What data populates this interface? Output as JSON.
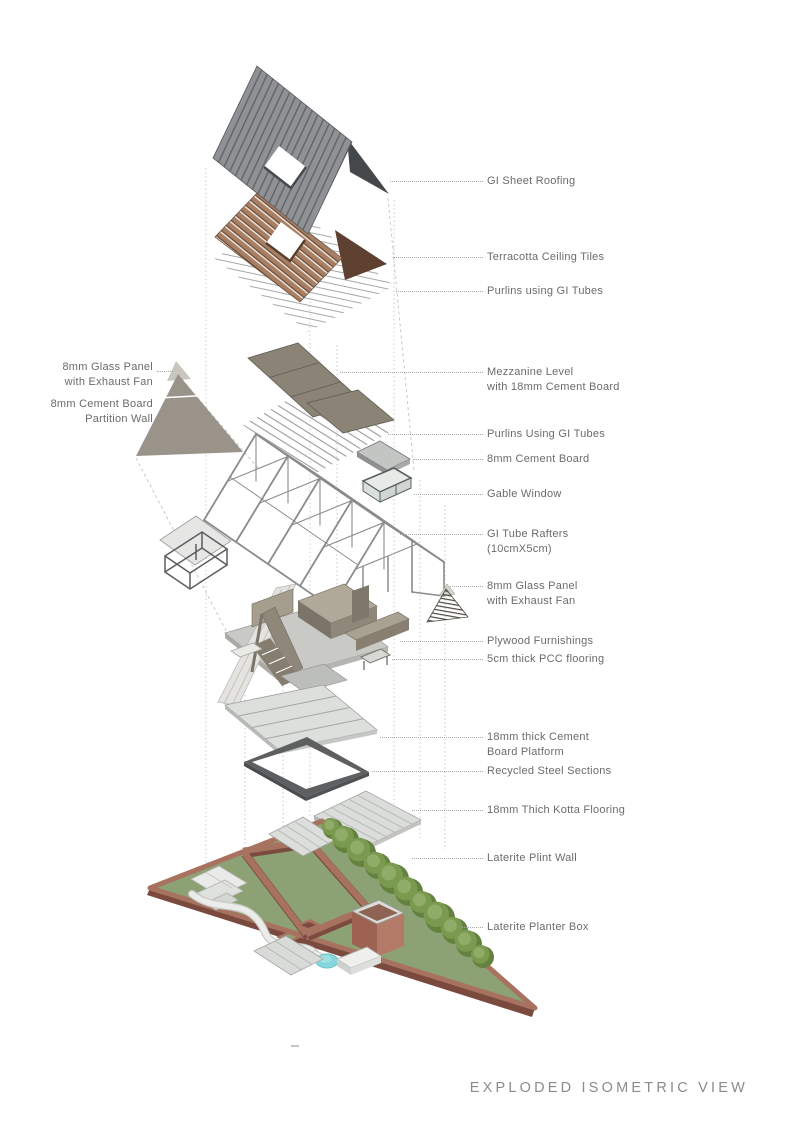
{
  "title": "EXPLODED ISOMETRIC VIEW",
  "callouts_right": [
    {
      "id": "gi-sheet-roofing",
      "lines": [
        "GI Sheet Roofing"
      ],
      "y": 181,
      "from_x": 390
    },
    {
      "id": "terracotta-ceiling-tiles",
      "lines": [
        "Terracotta Ceiling Tiles"
      ],
      "y": 257,
      "from_x": 393
    },
    {
      "id": "purlins-using-gi-tubes-upper",
      "lines": [
        "Purlins using GI Tubes"
      ],
      "y": 291,
      "from_x": 396
    },
    {
      "id": "mezzanine-level",
      "lines": [
        "Mezzanine Level",
        "with 18mm Cement Board"
      ],
      "y": 372,
      "from_x": 340
    },
    {
      "id": "purlins-using-gi-tubes-lower",
      "lines": [
        "Purlins Using GI Tubes"
      ],
      "y": 434,
      "from_x": 388
    },
    {
      "id": "cement-board-8mm",
      "lines": [
        "8mm Cement Board"
      ],
      "y": 459,
      "from_x": 413
    },
    {
      "id": "gable-window",
      "lines": [
        "Gable Window"
      ],
      "y": 494,
      "from_x": 414
    },
    {
      "id": "gi-tube-rafters",
      "lines": [
        "GI Tube Rafters",
        "(10cmX5cm)"
      ],
      "y": 534,
      "from_x": 400
    },
    {
      "id": "glass-panel-exhaust-fan-right",
      "lines": [
        "8mm Glass Panel",
        "with Exhaust Fan"
      ],
      "y": 586,
      "from_x": 450
    },
    {
      "id": "plywood-furnishings",
      "lines": [
        "Plywood Furnishings"
      ],
      "y": 641,
      "from_x": 400
    },
    {
      "id": "pcc-flooring",
      "lines": [
        "5cm thick PCC flooring"
      ],
      "y": 659,
      "from_x": 392
    },
    {
      "id": "cement-board-platform",
      "lines": [
        "18mm thick Cement",
        "Board Platform"
      ],
      "y": 737,
      "from_x": 380
    },
    {
      "id": "recycled-steel-sections",
      "lines": [
        "Recycled Steel Sections"
      ],
      "y": 771,
      "from_x": 372
    },
    {
      "id": "kotta-flooring",
      "lines": [
        "18mm Thich Kotta Flooring"
      ],
      "y": 810,
      "from_x": 412
    },
    {
      "id": "laterite-plint-wall",
      "lines": [
        "Laterite Plint Wall"
      ],
      "y": 858,
      "from_x": 412
    },
    {
      "id": "laterite-planter-box",
      "lines": [
        "Laterite Planter Box"
      ],
      "y": 927,
      "from_x": 462
    }
  ],
  "callouts_left": [
    {
      "id": "glass-panel-exhaust-fan-left",
      "lines": [
        "8mm Glass Panel",
        "with Exhaust Fan"
      ],
      "y": 367,
      "leader": true,
      "leader_y": 371,
      "to_x": 173
    },
    {
      "id": "cement-board-partition-wall",
      "lines": [
        "8mm Cement Board",
        "Partition Wall"
      ],
      "y": 404,
      "leader": false
    }
  ],
  "colors": {
    "gi_roof": "#8f9194",
    "gi_roof_stripe": "#5e6164",
    "gable_dark": "#45484a",
    "terracotta": "#a87f63",
    "terracotta_stripe": "#6b4a36",
    "terracotta_gable": "#5d4030",
    "mezzanine": "#8b8476",
    "truss_gray": "#898c8e",
    "partition_wall": "#9a9389",
    "furniture_taupe": "#968e7e",
    "floor_light": "#dbdad6",
    "platform": "#dddfdc",
    "steel_ring": "#5d5f61",
    "kotta": "#dbddda",
    "lawn_green": "#8ca274",
    "laterite": "#a87261",
    "laterite_dark": "#7c4b40",
    "bush_green": "#7a9a50",
    "pond_blue": "#85d6da",
    "label_text": "#6b6b6b"
  }
}
